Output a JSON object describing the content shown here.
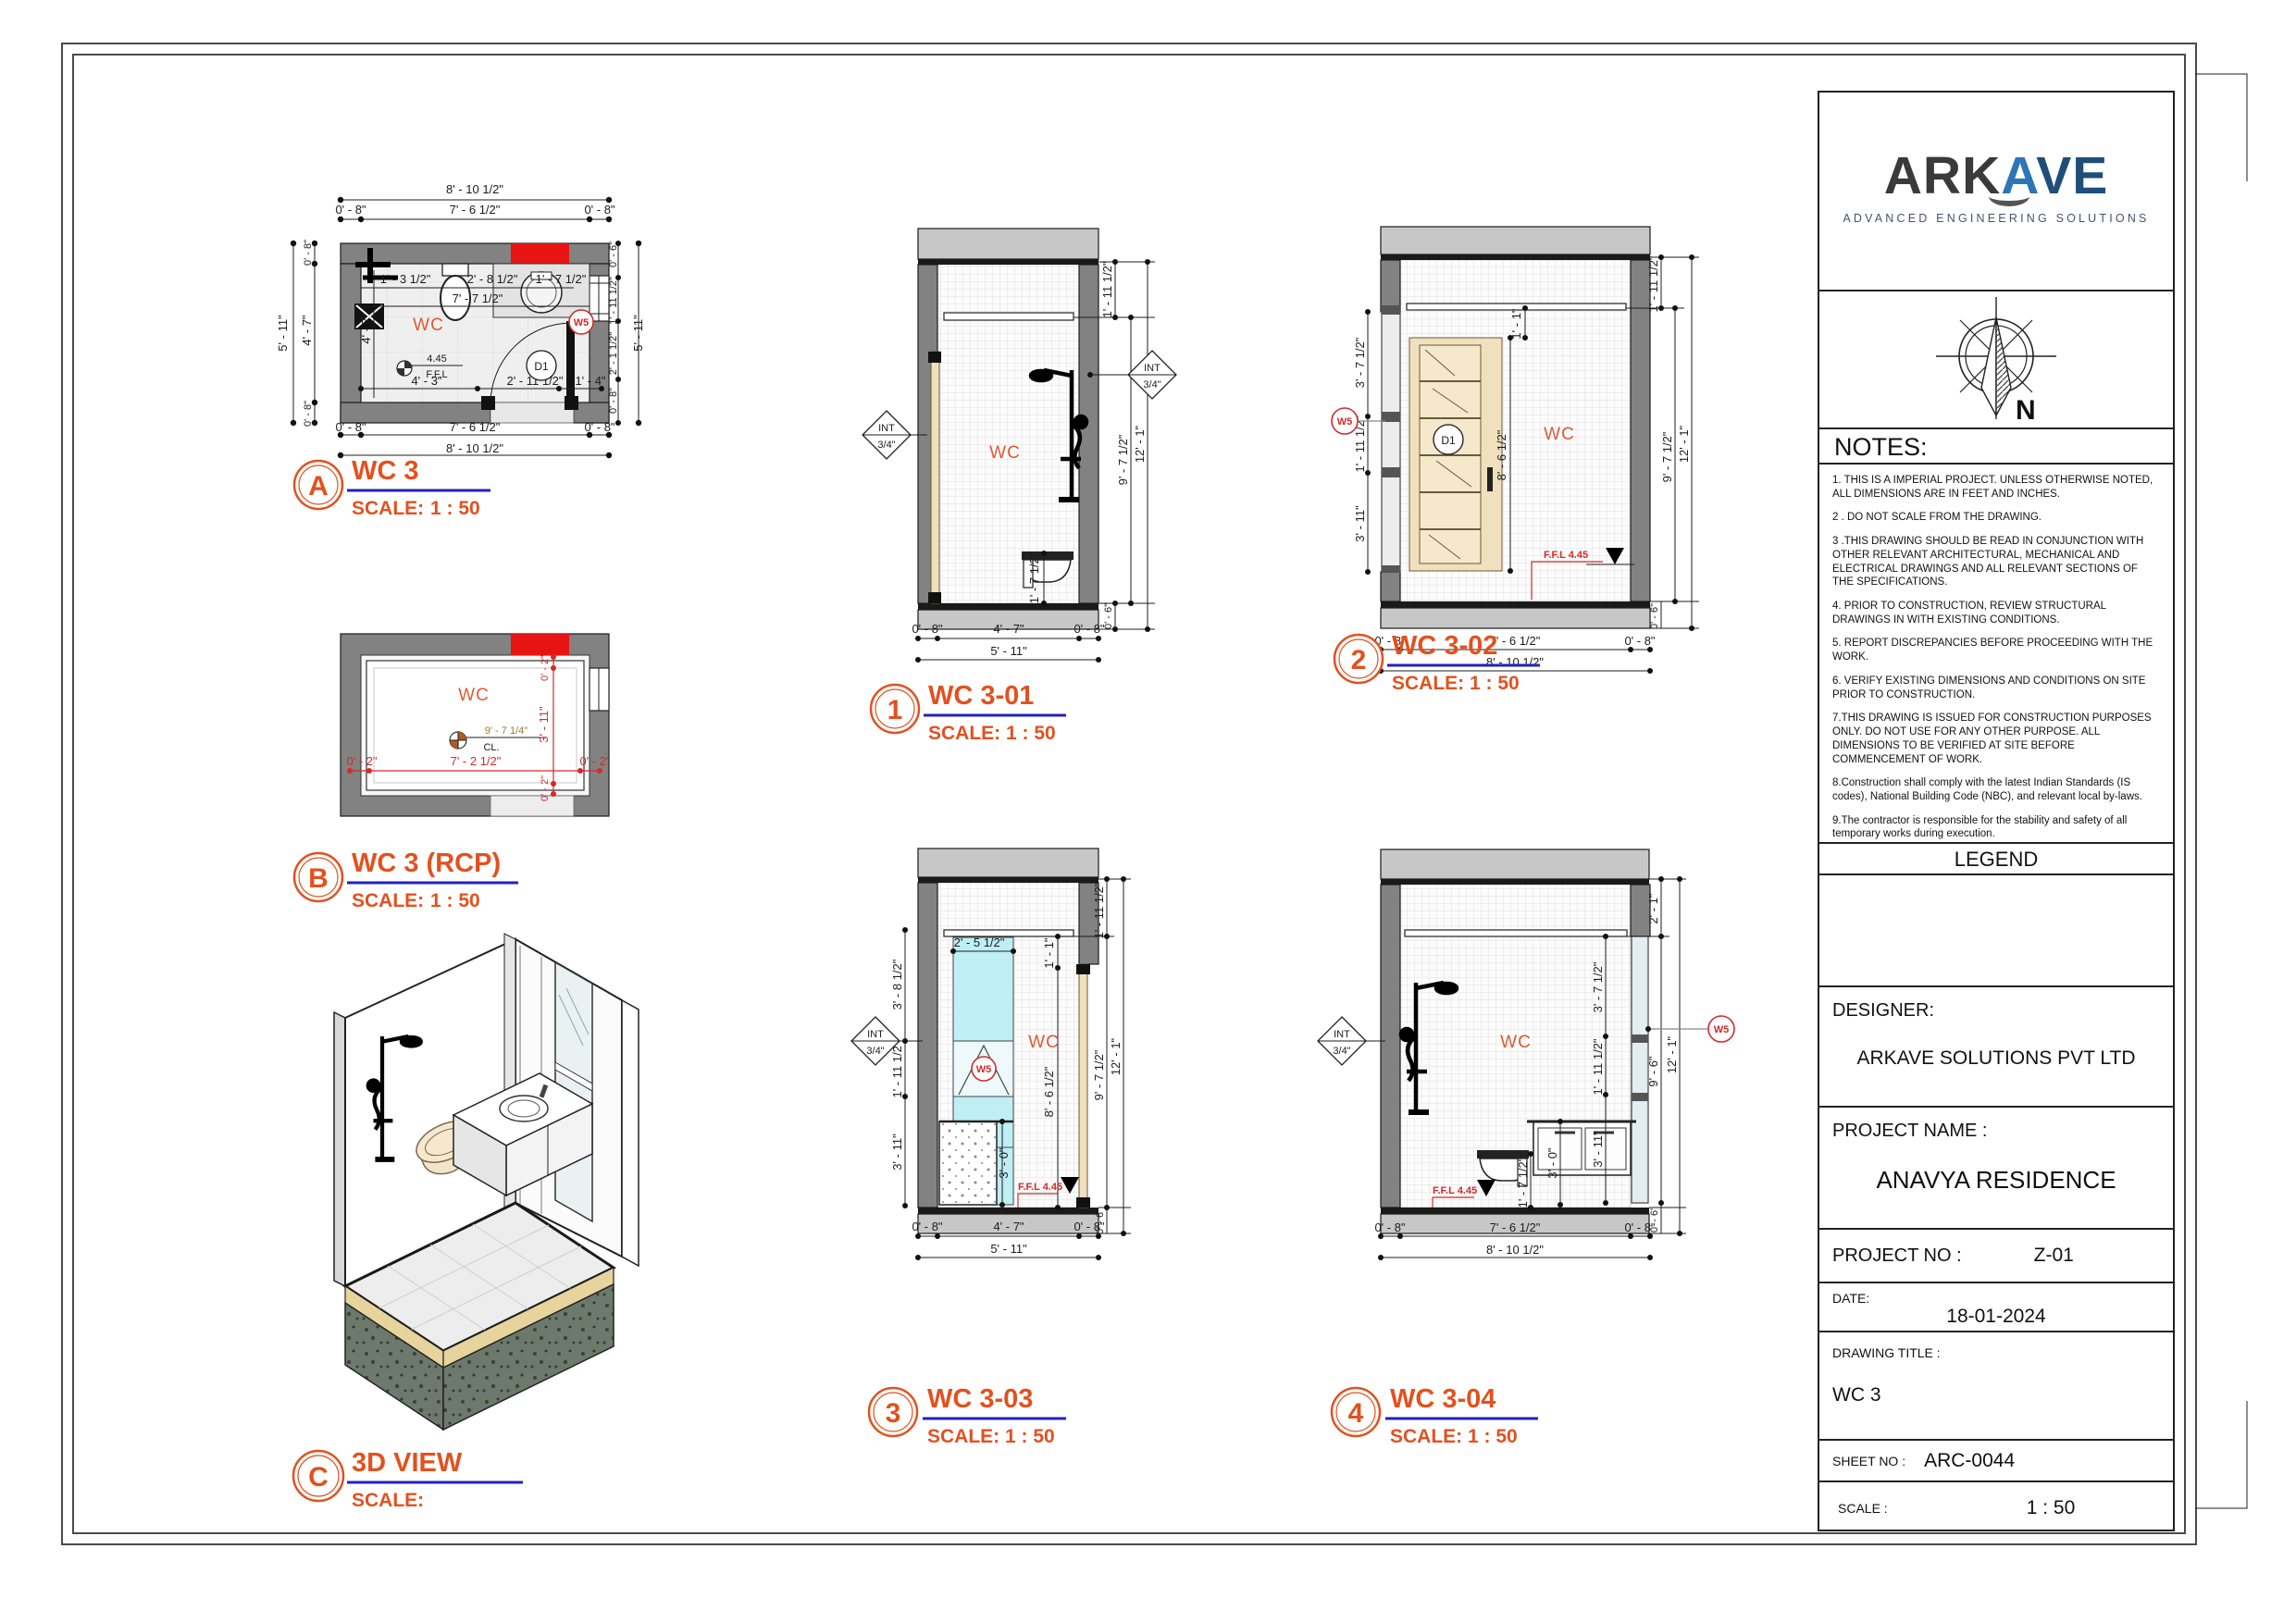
{
  "dims": {
    "d0_2": "0' - 2\"",
    "d0_6": "0' - 6\"",
    "d0_8": "0' - 8\"",
    "d1_1": "1' - 1\"",
    "d1_3h": "1' - 3 1/2\"",
    "d1_4": "1' - 4\"",
    "d1_7h": "1' - 7 1/2\"",
    "d1_11h": "1' - 11 1/2\"",
    "d2_1": "2' - 1\"",
    "d2_1h": "2' - 1 1/2\"",
    "d2_5h": "2' - 5 1/2\"",
    "d2_8h": "2' - 8 1/2\"",
    "d2_11h": "2' - 11 1/2\"",
    "d3_0": "3' - 0\"",
    "d3_7h": "3' - 7 1/2\"",
    "d3_8h": "3' - 8 1/2\"",
    "d3_11": "3' - 11\"",
    "d4_3": "4' - 3\"",
    "d4_7": "4' - 7\"",
    "d5_11": "5' - 11\"",
    "d7_2h": "7' - 2 1/2\"",
    "d7_6h": "7' - 6 1/2\"",
    "d7_7h": "7' - 7 1/2\"",
    "d8_6h": "8' - 6 1/2\"",
    "d8_10h": "8' - 10 1/2\"",
    "d9_6": "9' - 6\"",
    "d9_7q": "9' - 7 1/4\"",
    "d9_7h": "9' - 7 1/2\"",
    "d12_1": "12' - 1\""
  },
  "tags": {
    "room": "WC",
    "door": "D1",
    "window": "W5",
    "int": "INT",
    "int_size": "3/4\"",
    "ffl": "F.F.L 4.45",
    "ffl_value": "4.45",
    "ffl_label": "F.F.L",
    "cl": "CL.",
    "north": "N"
  },
  "views": {
    "plan": {
      "id": "A",
      "title": "WC 3",
      "scale_label": "SCALE:",
      "scale": "1 : 50"
    },
    "rcp": {
      "id": "B",
      "title": "WC 3 (RCP)",
      "scale_label": "SCALE:",
      "scale": "1 : 50"
    },
    "iso": {
      "id": "C",
      "title": "3D VIEW",
      "scale_label": "SCALE:",
      "scale": ""
    },
    "e1": {
      "id": "1",
      "title": "WC 3-01",
      "scale_label": "SCALE:",
      "scale": "1 : 50"
    },
    "e2": {
      "id": "2",
      "title": "WC 3-02",
      "scale_label": "SCALE:",
      "scale": "1 : 50"
    },
    "e3": {
      "id": "3",
      "title": "WC 3-03",
      "scale_label": "SCALE:",
      "scale": "1 : 50"
    },
    "e4": {
      "id": "4",
      "title": "WC 3-04",
      "scale_label": "SCALE:",
      "scale": "1 : 50"
    }
  },
  "titleblock": {
    "logo": {
      "word_dark": "ARK",
      "word_a": "A",
      "word_blue": "VE",
      "tagline": "ADVANCED ENGINEERING SOLUTIONS"
    },
    "north_label": "N",
    "notes_title": "NOTES:",
    "notes": [
      "1. THIS IS A IMPERIAL PROJECT. UNLESS OTHERWISE NOTED, ALL DIMENSIONS ARE IN FEET AND INCHES.",
      "2 . DO NOT SCALE FROM THE DRAWING.",
      "3 .THIS DRAWING SHOULD BE READ IN CONJUNCTION WITH OTHER RELEVANT ARCHITECTURAL, MECHANICAL AND ELECTRICAL DRAWINGS AND ALL RELEVANT SECTIONS OF THE SPECIFICATIONS.",
      "4. PRIOR TO CONSTRUCTION, REVIEW STRUCTURAL DRAWINGS IN  WITH EXISTING CONDITIONS.",
      "5. REPORT DISCREPANCIES BEFORE PROCEEDING WITH THE WORK.",
      "6. VERIFY EXISTING DIMENSIONS AND CONDITIONS ON SITE PRIOR TO CONSTRUCTION.",
      "7.THIS DRAWING IS ISSUED FOR CONSTRUCTION PURPOSES ONLY. DO NOT USE FOR ANY OTHER PURPOSE. ALL DIMENSIONS TO BE VERIFIED AT SITE BEFORE COMMENCEMENT OF WORK.",
      "8.Construction shall comply with the latest Indian Standards (IS codes), National Building Code (NBC), and relevant local by-laws.",
      "9.The contractor is responsible for the stability and safety of all temporary works during execution."
    ],
    "legend_title": "LEGEND",
    "designer_label": "DESIGNER:",
    "designer": "ARKAVE SOLUTIONS PVT LTD",
    "project_name_label": "PROJECT NAME :",
    "project_name": "ANAVYA RESIDENCE",
    "project_no_label": "PROJECT NO :",
    "project_no": "Z-01",
    "date_label": "DATE:",
    "date": "18-01-2024",
    "drawing_title_label": "DRAWING TITLE :",
    "drawing_title": "WC 3",
    "sheet_no_label": "SHEET NO :",
    "sheet_no": "ARC-0044",
    "scale_label": "SCALE :",
    "scale": "1 : 50"
  }
}
